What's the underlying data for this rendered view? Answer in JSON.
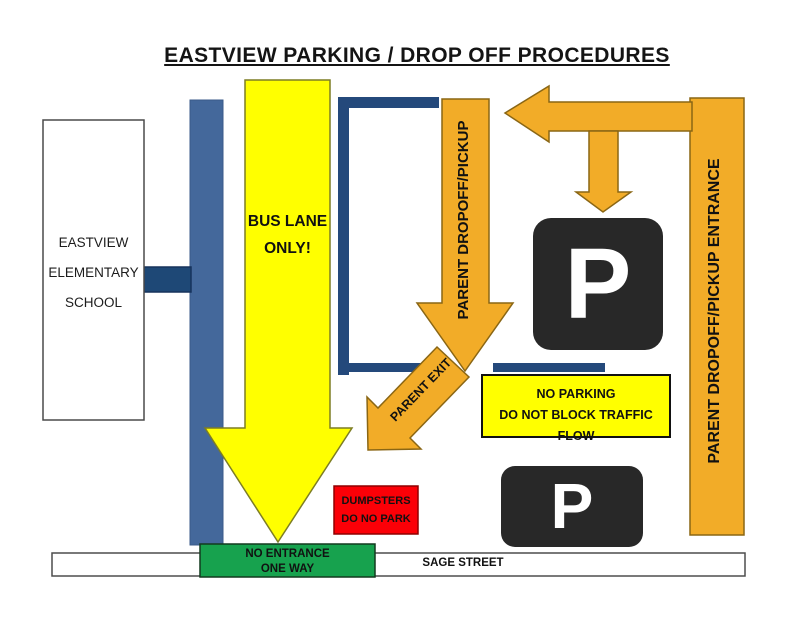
{
  "title": "EASTVIEW PARKING / DROP OFF PROCEDURES",
  "school": {
    "lines": [
      "EASTVIEW",
      "ELEMENTARY",
      "SCHOOL"
    ]
  },
  "bus_lane_arrow": {
    "lines": [
      "BUS LANE",
      "ONLY!"
    ]
  },
  "parent_dropoff_arrow": {
    "label": "PARENT DROPOFF/PICKUP"
  },
  "entrance_bar": {
    "label": "PARENT DROPOFF/PICKUP ENTRANCE"
  },
  "parent_exit_arrow": {
    "label": "PARENT EXIT"
  },
  "no_parking_sign": {
    "lines": [
      "NO PARKING",
      "DO NOT BLOCK TRAFFIC FLOW"
    ]
  },
  "dumpsters_sign": {
    "lines": [
      "DUMPSTERS",
      "DO NO PARK"
    ]
  },
  "no_entrance_sign": {
    "lines": [
      "NO ENTRANCE",
      "ONE WAY"
    ]
  },
  "street": {
    "label": "SAGE STREET"
  },
  "parking_sign": {
    "symbol": "P"
  },
  "colors": {
    "bus_lane_yellow": "#FFFF00",
    "parent_route_orange": "#F2AC28",
    "orange_border": "#8A6614",
    "building_bar_blue": "#44689B",
    "curb_dark_blue": "#24497B",
    "no_entrance_green": "#17A24E",
    "dumpster_red": "#FB0007",
    "parking_sign_black": "#282828"
  }
}
